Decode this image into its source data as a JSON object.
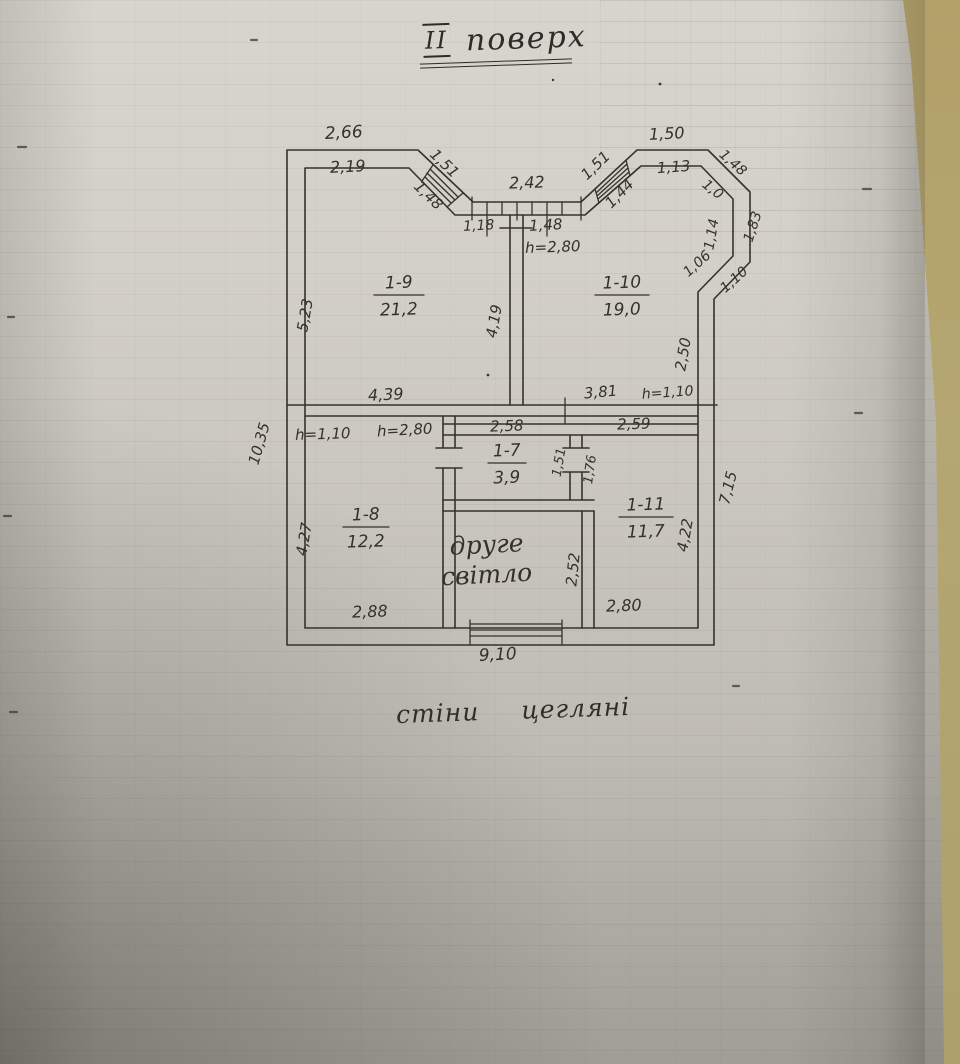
{
  "document": {
    "title": {
      "roman": "II",
      "word": "поверх"
    },
    "wall_note": {
      "word1": "стіни",
      "word2": "цегляні"
    }
  },
  "plan": {
    "rooms": [
      {
        "id": "1-9",
        "area": "21,2",
        "x": 399,
        "y": 288,
        "w": 50
      },
      {
        "id": "1-10",
        "area": "19,0",
        "x": 622,
        "y": 288,
        "w": 54
      },
      {
        "id": "1-7",
        "area": "3,9",
        "x": 507,
        "y": 456,
        "w": 38
      },
      {
        "id": "1-8",
        "area": "12,2",
        "x": 366,
        "y": 520,
        "w": 46
      },
      {
        "id": "1-11",
        "area": "11,7",
        "x": 646,
        "y": 510,
        "w": 54
      }
    ],
    "void_label": {
      "lines": [
        "друге",
        "світло"
      ],
      "x": 487,
      "y": 553,
      "line_height": 30
    },
    "dimensions": [
      {
        "v": "2,66",
        "x": 344,
        "y": 138,
        "r": -3,
        "s": 17
      },
      {
        "v": "2,19",
        "x": 348,
        "y": 172,
        "r": -3,
        "s": 16
      },
      {
        "v": "1,51",
        "x": 441,
        "y": 167,
        "r": 44,
        "s": 15
      },
      {
        "v": "1,48",
        "x": 425,
        "y": 199,
        "r": 44,
        "s": 15
      },
      {
        "v": "2,42",
        "x": 527,
        "y": 188,
        "r": -2,
        "s": 16
      },
      {
        "v": "1,18",
        "x": 479,
        "y": 230,
        "r": -3,
        "s": 14
      },
      {
        "v": "1,48",
        "x": 546,
        "y": 230,
        "r": -3,
        "s": 15
      },
      {
        "v": "h=2,80",
        "x": 553,
        "y": 252,
        "r": -2,
        "s": 15
      },
      {
        "v": "1,51",
        "x": 599,
        "y": 169,
        "r": -44,
        "s": 15
      },
      {
        "v": "1,44",
        "x": 623,
        "y": 197,
        "r": -46,
        "s": 15
      },
      {
        "v": "1,50",
        "x": 667,
        "y": 139,
        "r": -3,
        "s": 16
      },
      {
        "v": "1,13",
        "x": 674,
        "y": 172,
        "r": -4,
        "s": 15
      },
      {
        "v": "1,48",
        "x": 730,
        "y": 166,
        "r": 42,
        "s": 14
      },
      {
        "v": "1,0",
        "x": 710,
        "y": 193,
        "r": 38,
        "s": 14
      },
      {
        "v": "1,14",
        "x": 716,
        "y": 235,
        "r": -80,
        "s": 14
      },
      {
        "v": "1,83",
        "x": 757,
        "y": 228,
        "r": -72,
        "s": 14
      },
      {
        "v": "1,06",
        "x": 700,
        "y": 267,
        "r": -42,
        "s": 14
      },
      {
        "v": "1,10",
        "x": 737,
        "y": 283,
        "r": -42,
        "s": 14
      },
      {
        "v": "2,50",
        "x": 688,
        "y": 355,
        "r": -80,
        "s": 15
      },
      {
        "v": "5,23",
        "x": 310,
        "y": 316,
        "r": -80,
        "s": 15
      },
      {
        "v": "4,19",
        "x": 499,
        "y": 322,
        "r": -80,
        "s": 15
      },
      {
        "v": "10,35",
        "x": 264,
        "y": 445,
        "r": -74,
        "s": 15
      },
      {
        "v": "4,39",
        "x": 386,
        "y": 400,
        "r": -3,
        "s": 16
      },
      {
        "v": "3,81",
        "x": 601,
        "y": 397,
        "r": -5,
        "s": 15
      },
      {
        "v": "h=1,10",
        "x": 668,
        "y": 397,
        "r": -4,
        "s": 14
      },
      {
        "v": "h=1,10",
        "x": 323,
        "y": 439,
        "r": -2,
        "s": 15
      },
      {
        "v": "h=2,80",
        "x": 405,
        "y": 435,
        "r": -3,
        "s": 15
      },
      {
        "v": "2,58",
        "x": 507,
        "y": 431,
        "r": -2,
        "s": 15
      },
      {
        "v": "2,59",
        "x": 634,
        "y": 429,
        "r": -2,
        "s": 15
      },
      {
        "v": "1,51",
        "x": 563,
        "y": 463,
        "r": -80,
        "s": 13
      },
      {
        "v": "1,76",
        "x": 594,
        "y": 470,
        "r": -82,
        "s": 13
      },
      {
        "v": "4,27",
        "x": 309,
        "y": 540,
        "r": -80,
        "s": 15
      },
      {
        "v": "2,88",
        "x": 370,
        "y": 617,
        "r": -2,
        "s": 16
      },
      {
        "v": "2,52",
        "x": 578,
        "y": 570,
        "r": -84,
        "s": 15
      },
      {
        "v": "4,22",
        "x": 690,
        "y": 536,
        "r": -80,
        "s": 15
      },
      {
        "v": "2,80",
        "x": 624,
        "y": 611,
        "r": -2,
        "s": 16
      },
      {
        "v": "7,15",
        "x": 733,
        "y": 489,
        "r": -76,
        "s": 15
      },
      {
        "v": "9,10",
        "x": 498,
        "y": 660,
        "r": -3,
        "s": 17
      }
    ]
  }
}
